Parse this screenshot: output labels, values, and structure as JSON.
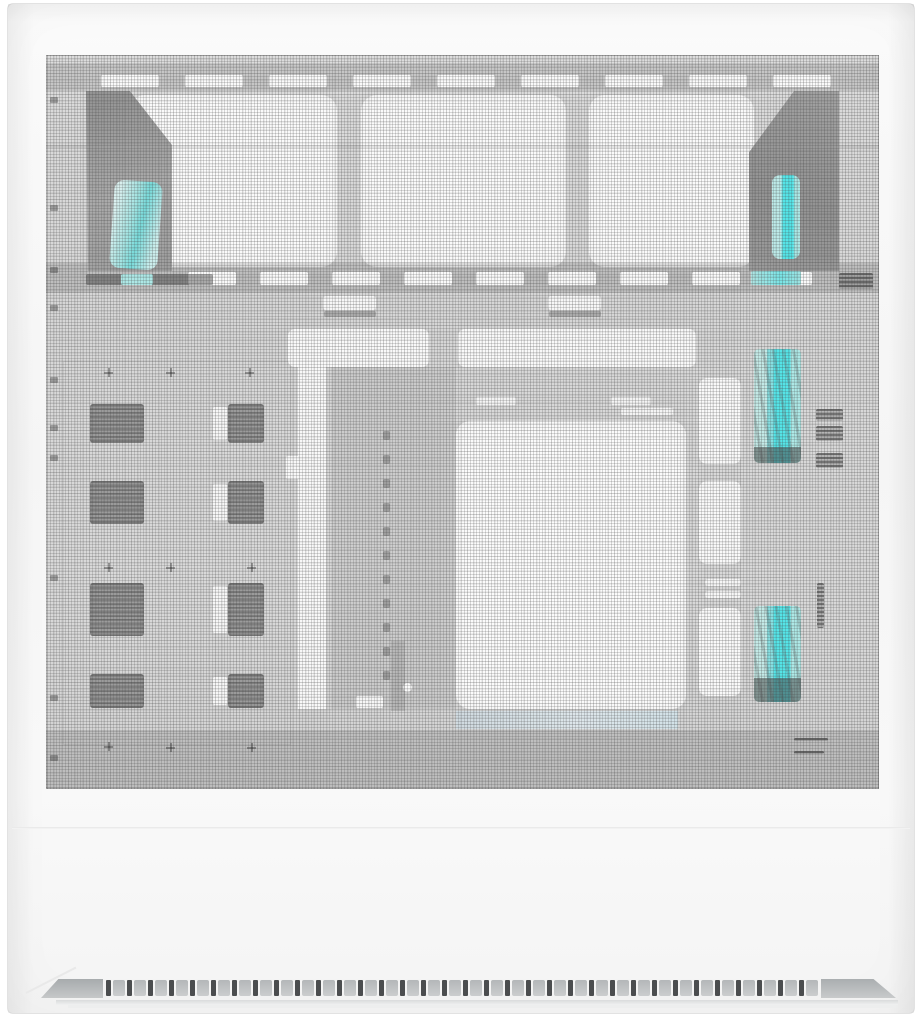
{
  "scene": {
    "type": "product-photo",
    "subject": "white mid-tower PC case, side view through full micro-mesh panel",
    "background": "white studio backdrop",
    "visible_text": ""
  },
  "colors": {
    "page-bg": "#ffffff",
    "case-body": "#f8f8f8",
    "case-edge": "#e2e2e2",
    "mesh-base": "#d6d6d6",
    "mesh-line": "rgba(70,70,70,0.20)",
    "interior-white": "#fafafa",
    "interior-dark": "#8e8e8e",
    "accent-cyan": "#49e2e6",
    "accent-cyan-soft": "#a8e7e5",
    "vent-dark": "#4b4d4f",
    "vent-gray": "#cbcdce",
    "blue-reflection": "#cfe2ea"
  },
  "panel": {
    "top_rail_slot_count": 9,
    "mid_rail_slot_count": 9,
    "fan_cutout_count": 3,
    "subslot_x": [
      277,
      502
    ],
    "hook_rows": [
      {
        "y": 349,
        "h": 39
      },
      {
        "y": 426,
        "h": 43
      },
      {
        "y": 528,
        "h": 53
      },
      {
        "y": 619,
        "h": 34
      }
    ],
    "hook_a_x": 44,
    "hook_a_w": 54,
    "hook_tick_x": 167,
    "hook_tick_w": 14,
    "hook_b_x": 182,
    "hook_b_w": 36,
    "cross_marks": [
      [
        58,
        313
      ],
      [
        120,
        313
      ],
      [
        199,
        313
      ],
      [
        58,
        508
      ],
      [
        120,
        508
      ],
      [
        201,
        508
      ],
      [
        58,
        687
      ],
      [
        120,
        688
      ],
      [
        201,
        688
      ]
    ],
    "zipper": {
      "count": 11,
      "x": 337,
      "start_y": 376,
      "step": 24
    },
    "mini_dashes": [
      [
        430,
        342,
        40,
        8
      ],
      [
        565,
        342,
        40,
        8
      ],
      [
        575,
        353,
        52,
        7
      ]
    ],
    "right_dark_marks": [
      [
        770,
        183,
        22,
        11
      ],
      [
        793,
        218,
        34,
        16
      ],
      [
        770,
        354,
        27,
        12
      ],
      [
        770,
        371,
        27,
        15
      ],
      [
        770,
        398,
        27,
        15
      ],
      [
        771,
        528,
        7,
        45
      ],
      [
        748,
        683,
        34,
        3
      ],
      [
        748,
        696,
        30,
        3
      ]
    ],
    "left_edge_dot_ys": [
      42,
      150,
      212,
      250,
      322,
      370,
      400,
      520,
      640,
      700
    ],
    "fans": {
      "blade_color": "#49e2e6",
      "positions": [
        "top-left-exhaust",
        "top-right-corner",
        "right-upper-intake",
        "right-lower-intake"
      ]
    }
  },
  "vent": {
    "pair_count": 34,
    "dark_width": 5,
    "gray_width": 12,
    "gap": 2,
    "height": 16
  }
}
